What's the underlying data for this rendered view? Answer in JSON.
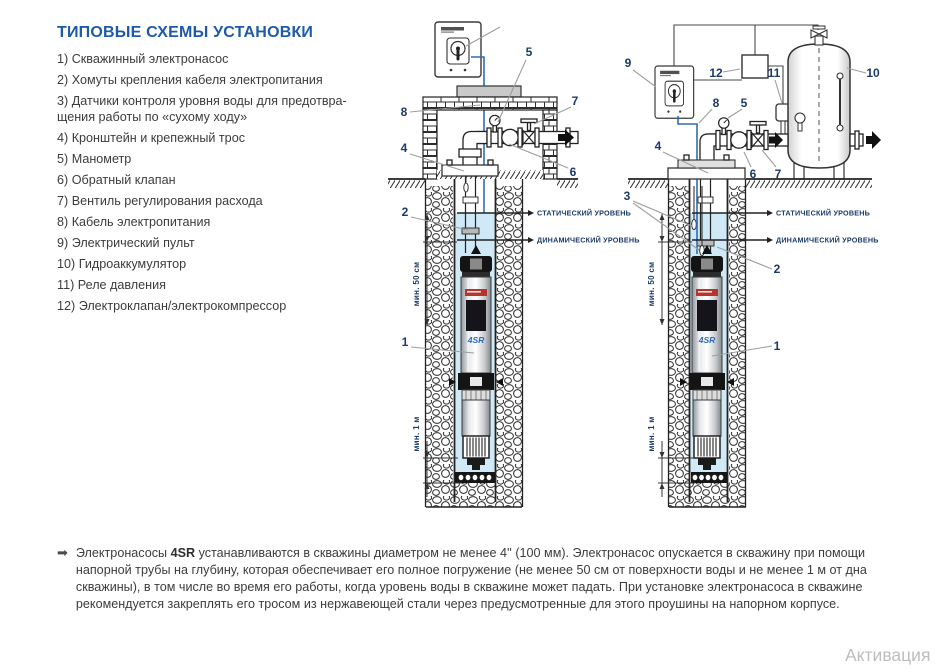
{
  "page": {
    "title": "ТИПОВЫЕ СХЕМЫ УСТАНОВКИ"
  },
  "legend": {
    "items": [
      "1) Скважинный электронасос",
      "2) Хомуты крепления кабеля электропитания",
      "3) Датчики контроля уровня воды для предотвра-\nщения работы по «сухому ходу»",
      "4) Кронштейн и крепежный трос",
      "5) Манометр",
      "6) Обратный клапан",
      "7) Вентиль регулирования расхода",
      "8) Кабель электропитания",
      "9) Электрический пульт",
      "10) Гидроаккумулятор",
      "11) Реле давления",
      "12) Электроклапан/электрокомпрессор"
    ]
  },
  "diagrams": {
    "callouts": {
      "c1": "1",
      "c2": "2",
      "c3": "3",
      "c4": "4",
      "c5": "5",
      "c6": "6",
      "c7": "7",
      "c8": "8",
      "c9": "9",
      "c10": "10",
      "c11": "11",
      "c12": "12"
    },
    "labels": {
      "static_level": "СТАТИЧЕСКИЙ УРОВЕНЬ",
      "dynamic_level": "ДИНАМИЧЕСКИЙ УРОВЕНЬ",
      "min_50cm": "мин. 50 см",
      "min_1m": "мин. 1 м",
      "pump_model": "4SR"
    },
    "colors": {
      "water": "#cfe9f6",
      "cable_blue": "#2f6db5",
      "callout_navy": "#1b3a67",
      "title_blue": "#1d5ba8"
    }
  },
  "footer": {
    "bullet": "➡",
    "text_before": "Электронасосы ",
    "bold": "4SR",
    "text_after": " устанавливаются в скважины диаметром не менее 4'' (100 мм). Электронасос опускается в скважину при помощи напорной трубы на глубину, которая обеспечивает его полное погружение (не менее 50 см от поверхности воды и не менее 1 м от дна скважины), в том числе во время его работы, когда уровень воды в скважине может падать. При установке электронасоса в скважине рекомендуется закреплять его тросом из нержавеющей стали через предусмотренные для этого проушины на напорном корпусе."
  },
  "watermark": {
    "text": "Активация"
  }
}
